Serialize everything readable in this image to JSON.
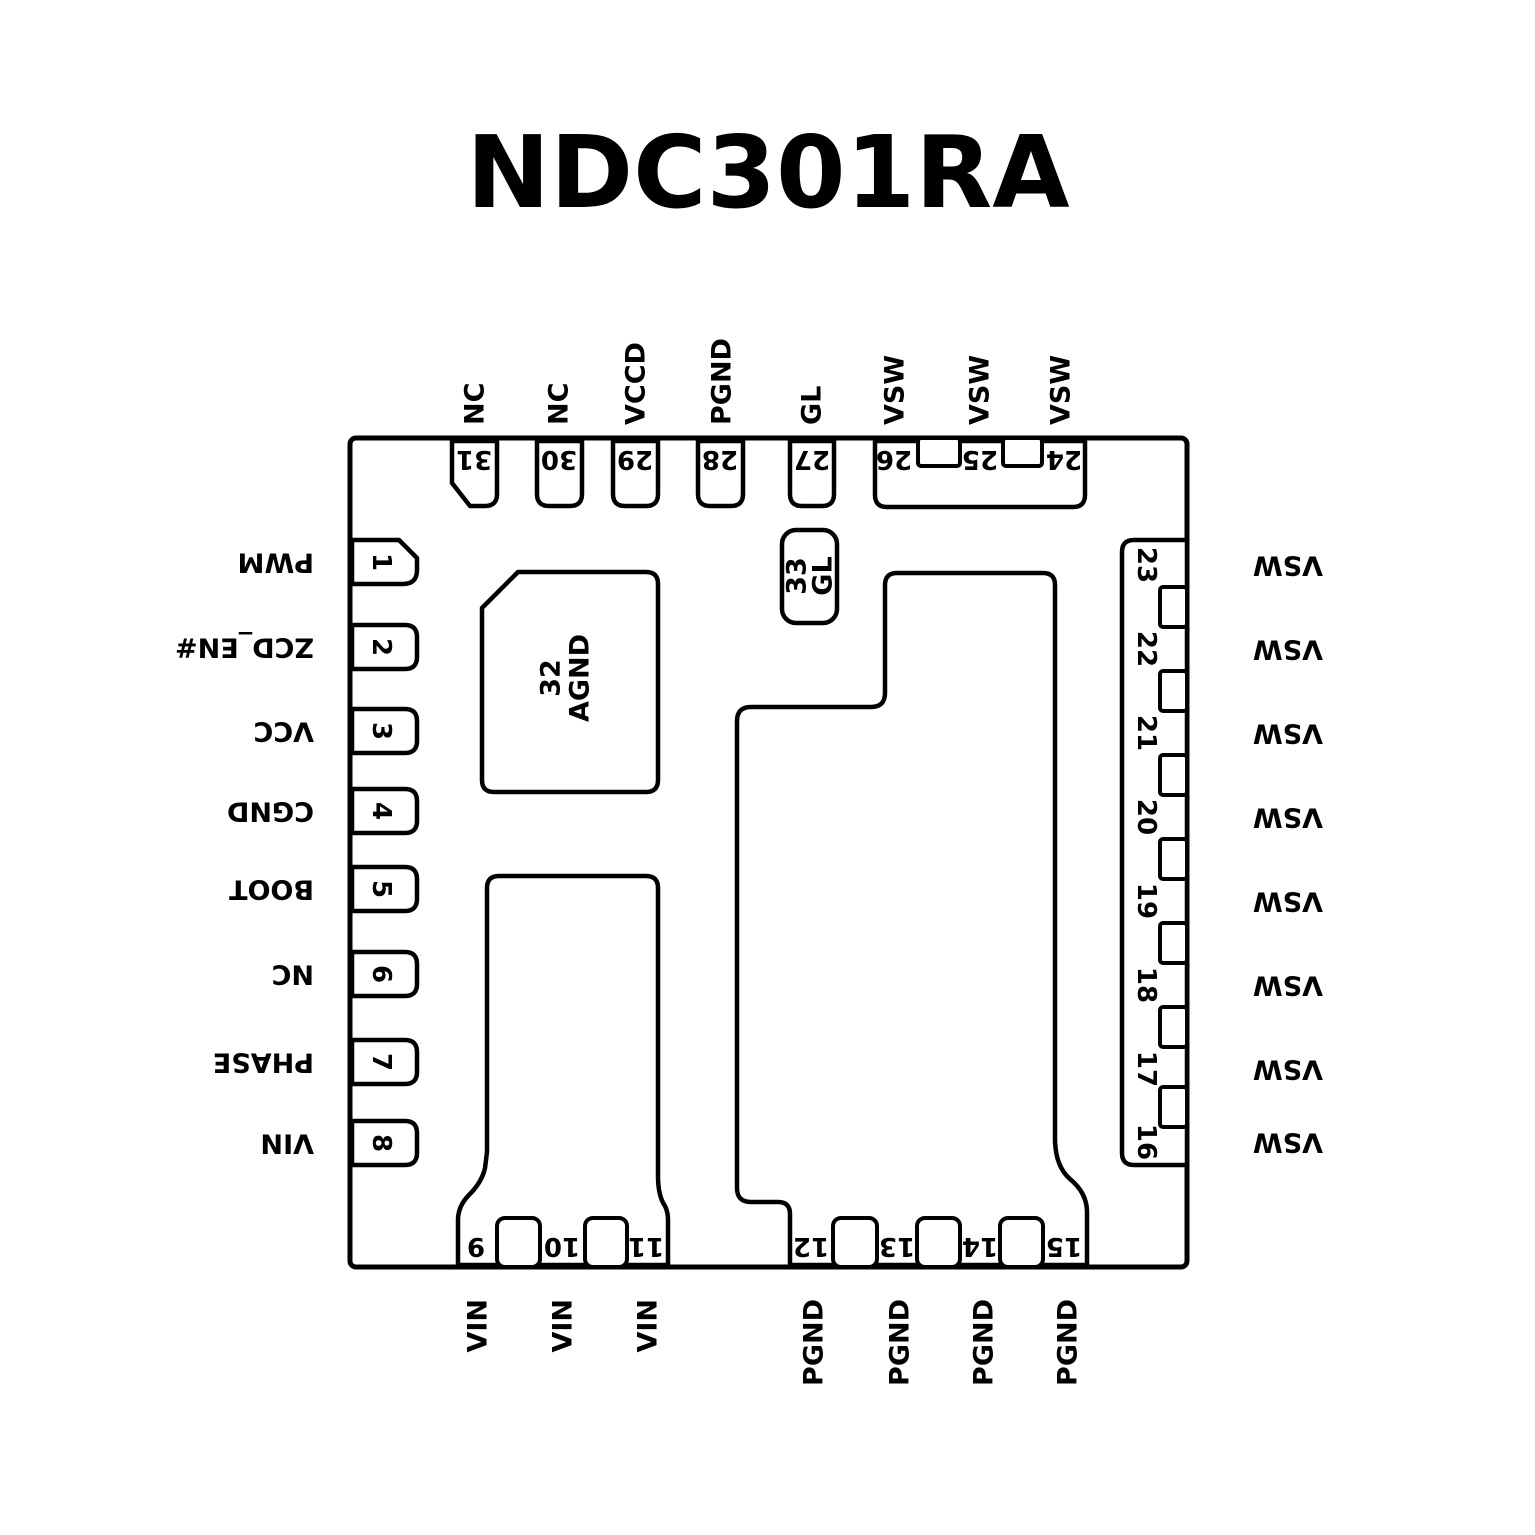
{
  "title": "NDC301RA",
  "colors": {
    "line": "#000000",
    "background": "#ffffff",
    "text": "#000000"
  },
  "package": {
    "top_pins": [
      {
        "number": "31",
        "label": "NC"
      },
      {
        "number": "30",
        "label": "NC"
      },
      {
        "number": "29",
        "label": "VCCD"
      },
      {
        "number": "28",
        "label": "PGND"
      },
      {
        "number": "27",
        "label": "GL"
      },
      {
        "number": "26",
        "label": "VSW"
      },
      {
        "number": "25",
        "label": "VSW"
      },
      {
        "number": "24",
        "label": "VSW"
      }
    ],
    "left_pins": [
      {
        "number": "1",
        "label": "PWM"
      },
      {
        "number": "2",
        "label": "ZCD_EN#"
      },
      {
        "number": "3",
        "label": "VCC"
      },
      {
        "number": "4",
        "label": "CGND"
      },
      {
        "number": "5",
        "label": "BOOT"
      },
      {
        "number": "6",
        "label": "NC"
      },
      {
        "number": "7",
        "label": "PHASE"
      },
      {
        "number": "8",
        "label": "VIN"
      }
    ],
    "right_pins": [
      {
        "number": "23",
        "label": "VSW"
      },
      {
        "number": "22",
        "label": "VSW"
      },
      {
        "number": "21",
        "label": "VSW"
      },
      {
        "number": "20",
        "label": "VSW"
      },
      {
        "number": "19",
        "label": "VSW"
      },
      {
        "number": "18",
        "label": "VSW"
      },
      {
        "number": "17",
        "label": "VSW"
      },
      {
        "number": "16",
        "label": "VSW"
      }
    ],
    "bottom_pins": [
      {
        "number": "9",
        "label": "VIN"
      },
      {
        "number": "10",
        "label": "VIN"
      },
      {
        "number": "11",
        "label": "VIN"
      },
      {
        "number": "12",
        "label": "PGND"
      },
      {
        "number": "13",
        "label": "PGND"
      },
      {
        "number": "14",
        "label": "PGND"
      },
      {
        "number": "15",
        "label": "PGND"
      }
    ],
    "thermal_pads": [
      {
        "number": "32",
        "label": "AGND"
      },
      {
        "number": "33",
        "label": "GL"
      }
    ]
  }
}
